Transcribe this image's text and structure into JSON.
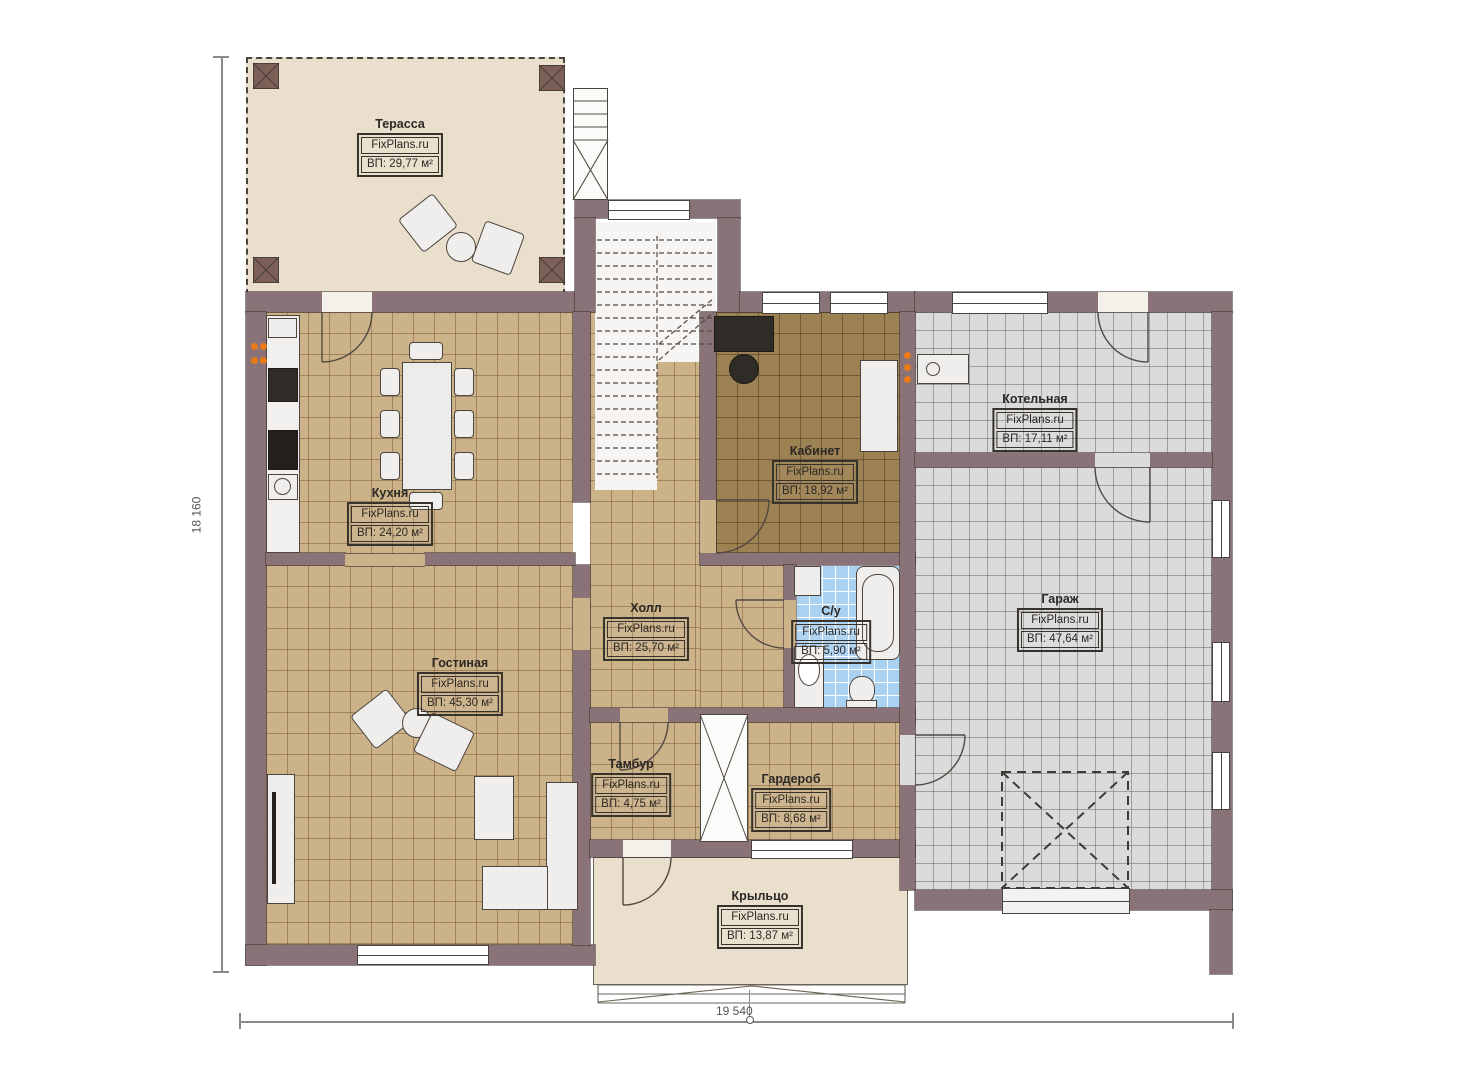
{
  "plan": {
    "watermark": "FixPlans.ru",
    "dim_width": "19 540",
    "dim_height": "18 160"
  },
  "rooms": {
    "terrace": {
      "name": "Терасса",
      "area": "ВП: 29,77 м²"
    },
    "kitchen": {
      "name": "Кухня",
      "area": "ВП: 24,20 м²"
    },
    "study": {
      "name": "Кабинет",
      "area": "ВП: 18,92 м²"
    },
    "boiler": {
      "name": "Котельная",
      "area": "ВП: 17,11 м²"
    },
    "garage": {
      "name": "Гараж",
      "area": "ВП: 47,64 м²"
    },
    "hall": {
      "name": "Холл",
      "area": "ВП: 25,70 м²"
    },
    "bathroom": {
      "name": "С/у",
      "area": "ВП: 5,90 м²"
    },
    "living": {
      "name": "Гостиная",
      "area": "ВП: 45,30 м²"
    },
    "vestibule": {
      "name": "Тамбур",
      "area": "ВП: 4,75 м²"
    },
    "wardrobe": {
      "name": "Гардероб",
      "area": "ВП: 8,68 м²"
    },
    "porch": {
      "name": "Крыльцо",
      "area": "ВП: 13,87 м²"
    }
  },
  "colors": {
    "wall": "#8a7378",
    "tile_tan": "#cbb289",
    "tile_brown": "#9c8152",
    "tile_blue": "#abd1f1",
    "tile_gray": "#dbdbdb",
    "deck": "#e9dfcc"
  }
}
